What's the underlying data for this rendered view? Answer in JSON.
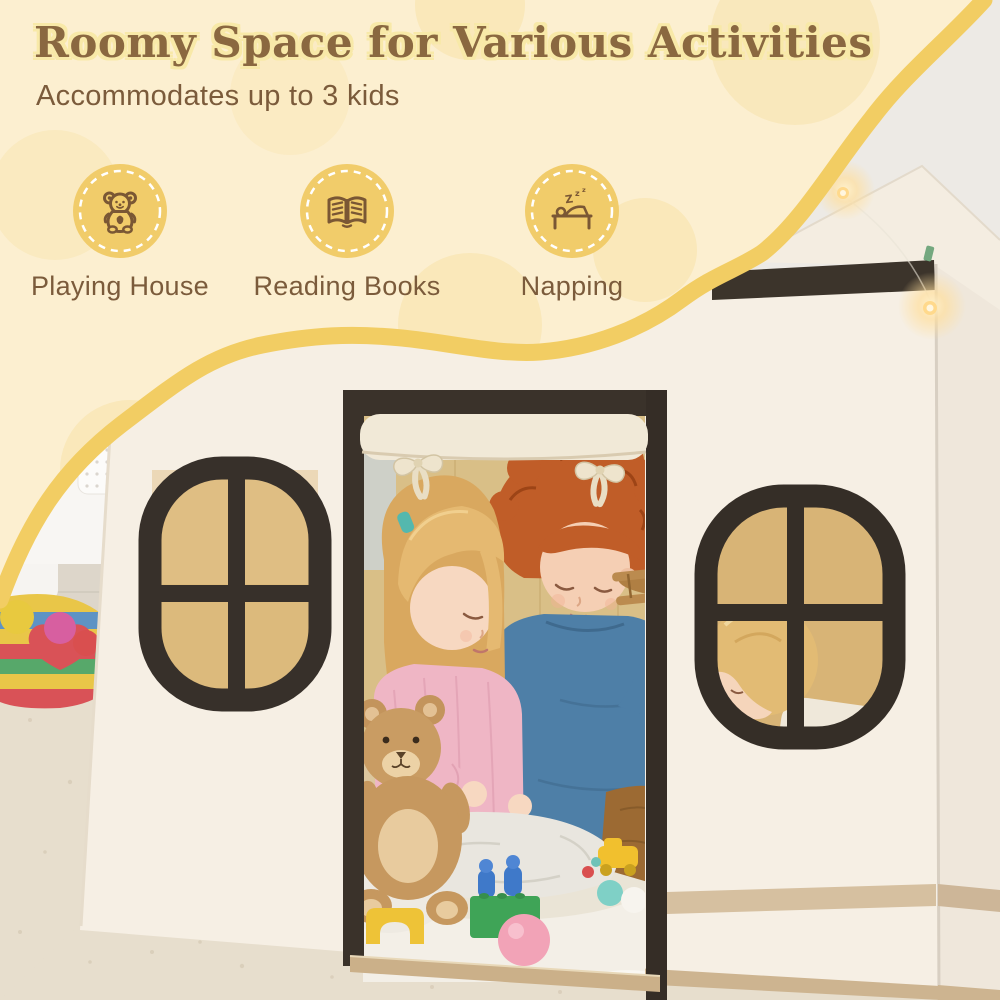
{
  "header": {
    "title": "Roomy Space for Various Activities",
    "subtitle": "Accommodates up to 3 kids"
  },
  "features": [
    {
      "id": "playing-house",
      "icon": "teddy-bear-icon",
      "label": "Playing House"
    },
    {
      "id": "reading-books",
      "icon": "open-book-icon",
      "label": "Reading Books"
    },
    {
      "id": "napping",
      "icon": "sleeping-bed-icon",
      "label": "Napping",
      "zzz": [
        "Z",
        "z",
        "z"
      ]
    }
  ],
  "photo": {
    "description": "Three children playing inside a cream canvas playhouse with dark brown window and door trim: a girl in a pink sweater holding a teddy bear, a boy with curly red hair in a blue sweater holding a wooden toy plane, and a blonde toddler peeking through the side window; white fluffy rug with toy blocks and balls, rainbow pom-pom play mat on the floor, warm string lights on the roof edge"
  },
  "colors": {
    "background_cream": "#fcefd0",
    "wave_yellow": "#f2cd63",
    "title_brown": "#8a6840",
    "title_outline": "#f8e9a8",
    "text_brown": "#7b5b3b",
    "badge_yellow": "#f1cc6a",
    "badge_glyph_brown": "#7a5734",
    "trim_dark_brown": "#3a322a",
    "window_pane_tan": "#d9b577",
    "house_wall_cream": "#f6efe4"
  }
}
